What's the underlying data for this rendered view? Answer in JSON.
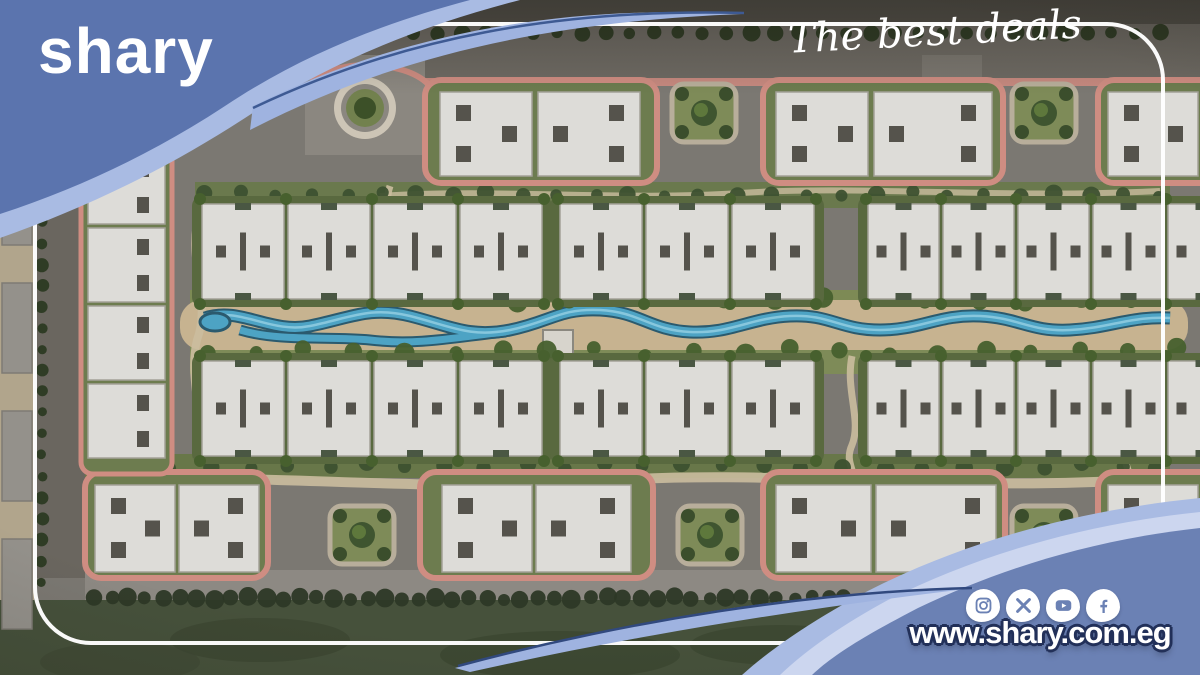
{
  "brand": {
    "logo_text": "shary",
    "tagline": "The best deals",
    "website": "www.shary.com.eg",
    "colors": {
      "swoosh_dark": "#5b74ae",
      "swoosh_light": "#a9bbe3",
      "swoosh_pale": "#ccd6ef",
      "swoosh_body": "#6b81b4",
      "outline_navy": "#223059",
      "text_white": "#ffffff"
    }
  },
  "social": {
    "icons": [
      {
        "name": "instagram-icon"
      },
      {
        "name": "x-icon"
      },
      {
        "name": "youtube-icon"
      },
      {
        "name": "facebook-icon"
      }
    ]
  },
  "plan": {
    "description": "aerial masterplan rendering of residential compound with central winding canal",
    "palette": {
      "building": "#dddcd8",
      "building_edge": "#a3a198",
      "mark": "#55534c",
      "notch": "#4a5743",
      "hedge": "#59693f",
      "cluster_green": "#6d7c4f",
      "pink": "#cf8d82",
      "lawn": "#7e8b58",
      "stone": "#b8ae9b",
      "tree": "#47602e",
      "tree_dark": "#2c3a22",
      "tree_light": "#6a8440",
      "canal": "#4da3c4",
      "canal_dark": "#2b5a6e",
      "canal_light": "#9fd6e8",
      "sand": "#c7b390",
      "sand_path": "#cbbd9f",
      "grass_dark": "#2d3826"
    },
    "tree_rows": [
      {
        "x0": 245,
        "y0": 33,
        "x1": 1160,
        "y1": 33,
        "sp": 24,
        "r": 7,
        "j": 1,
        "c": "#2c3a22"
      },
      {
        "x0": 42,
        "y0": 95,
        "x1": 42,
        "y1": 582,
        "sp": 21,
        "r": 5.5,
        "j": 1,
        "c": "#2c3a22"
      },
      {
        "x0": 205,
        "y0": 194,
        "x1": 1160,
        "y1": 194,
        "sp": 36,
        "r": 7,
        "j": 3,
        "c": "#3d5130"
      },
      {
        "x0": 210,
        "y0": 298,
        "x1": 1180,
        "y1": 298,
        "sp": 52,
        "r": 8,
        "j": 5,
        "c": "#47602e"
      },
      {
        "x0": 210,
        "y0": 352,
        "x1": 1180,
        "y1": 352,
        "sp": 48,
        "r": 8,
        "j": 5,
        "c": "#47602e"
      },
      {
        "x0": 90,
        "y0": 466,
        "x1": 1160,
        "y1": 466,
        "sp": 40,
        "r": 7,
        "j": 4,
        "c": "#3d5130"
      },
      {
        "x0": 95,
        "y0": 598,
        "x1": 845,
        "y1": 598,
        "sp": 17,
        "r": 7.5,
        "j": 2,
        "c": "#2d3826"
      }
    ],
    "left_plots": {
      "x": 2,
      "w": 30,
      "h": 90,
      "ys": [
        58,
        155,
        283,
        411,
        539
      ]
    },
    "row_groups": [
      {
        "x": 200,
        "y": 204,
        "uw": 86,
        "h": 95,
        "units": 4
      },
      {
        "x": 558,
        "y": 204,
        "uw": 86,
        "h": 95,
        "units": 3
      },
      {
        "x": 866,
        "y": 204,
        "uw": 75,
        "h": 95,
        "units": 5
      },
      {
        "x": 200,
        "y": 361,
        "uw": 86,
        "h": 95,
        "units": 4
      },
      {
        "x": 558,
        "y": 361,
        "uw": 86,
        "h": 95,
        "units": 3
      },
      {
        "x": 866,
        "y": 361,
        "uw": 75,
        "h": 95,
        "units": 5
      }
    ],
    "clusters": [
      {
        "x": 425,
        "y": 80,
        "w": 232,
        "h": 103,
        "by": 92,
        "bh": 84,
        "buildings": [
          {
            "x": 440,
            "w": 92,
            "p": "A"
          },
          {
            "x": 538,
            "w": 102,
            "p": "B"
          }
        ]
      },
      {
        "x": 763,
        "y": 80,
        "w": 240,
        "h": 103,
        "by": 92,
        "bh": 84,
        "buildings": [
          {
            "x": 776,
            "w": 92,
            "p": "A"
          },
          {
            "x": 874,
            "w": 118,
            "p": "B"
          }
        ]
      },
      {
        "x": 1098,
        "y": 80,
        "w": 120,
        "h": 103,
        "by": 92,
        "bh": 84,
        "buildings": [
          {
            "x": 1108,
            "w": 90,
            "p": "A"
          }
        ]
      },
      {
        "x": 85,
        "y": 472,
        "w": 183,
        "h": 106,
        "by": 485,
        "bh": 87,
        "buildings": [
          {
            "x": 95,
            "w": 80,
            "p": "A"
          },
          {
            "x": 179,
            "w": 80,
            "p": "B"
          }
        ]
      },
      {
        "x": 420,
        "y": 472,
        "w": 233,
        "h": 106,
        "by": 485,
        "bh": 87,
        "buildings": [
          {
            "x": 442,
            "w": 90,
            "p": "A"
          },
          {
            "x": 536,
            "w": 95,
            "p": "B"
          }
        ]
      },
      {
        "x": 763,
        "y": 472,
        "w": 242,
        "h": 106,
        "by": 485,
        "bh": 87,
        "buildings": [
          {
            "x": 776,
            "w": 95,
            "p": "A"
          },
          {
            "x": 876,
            "w": 120,
            "p": "B"
          }
        ]
      },
      {
        "x": 1098,
        "y": 472,
        "w": 120,
        "h": 106,
        "by": 485,
        "bh": 87,
        "buildings": [
          {
            "x": 1108,
            "w": 90,
            "p": "A"
          }
        ]
      }
    ],
    "parks": [
      {
        "x": 672,
        "y": 84
      },
      {
        "x": 1012,
        "y": 84
      },
      {
        "x": 330,
        "y": 506
      },
      {
        "x": 678,
        "y": 506
      },
      {
        "x": 1012,
        "y": 506
      }
    ],
    "park_size": {
      "w": 64,
      "h": 58
    },
    "left_column": {
      "x": 88,
      "y": 150,
      "w": 77,
      "unit_h": 74,
      "count": 4,
      "gap": 4
    }
  }
}
